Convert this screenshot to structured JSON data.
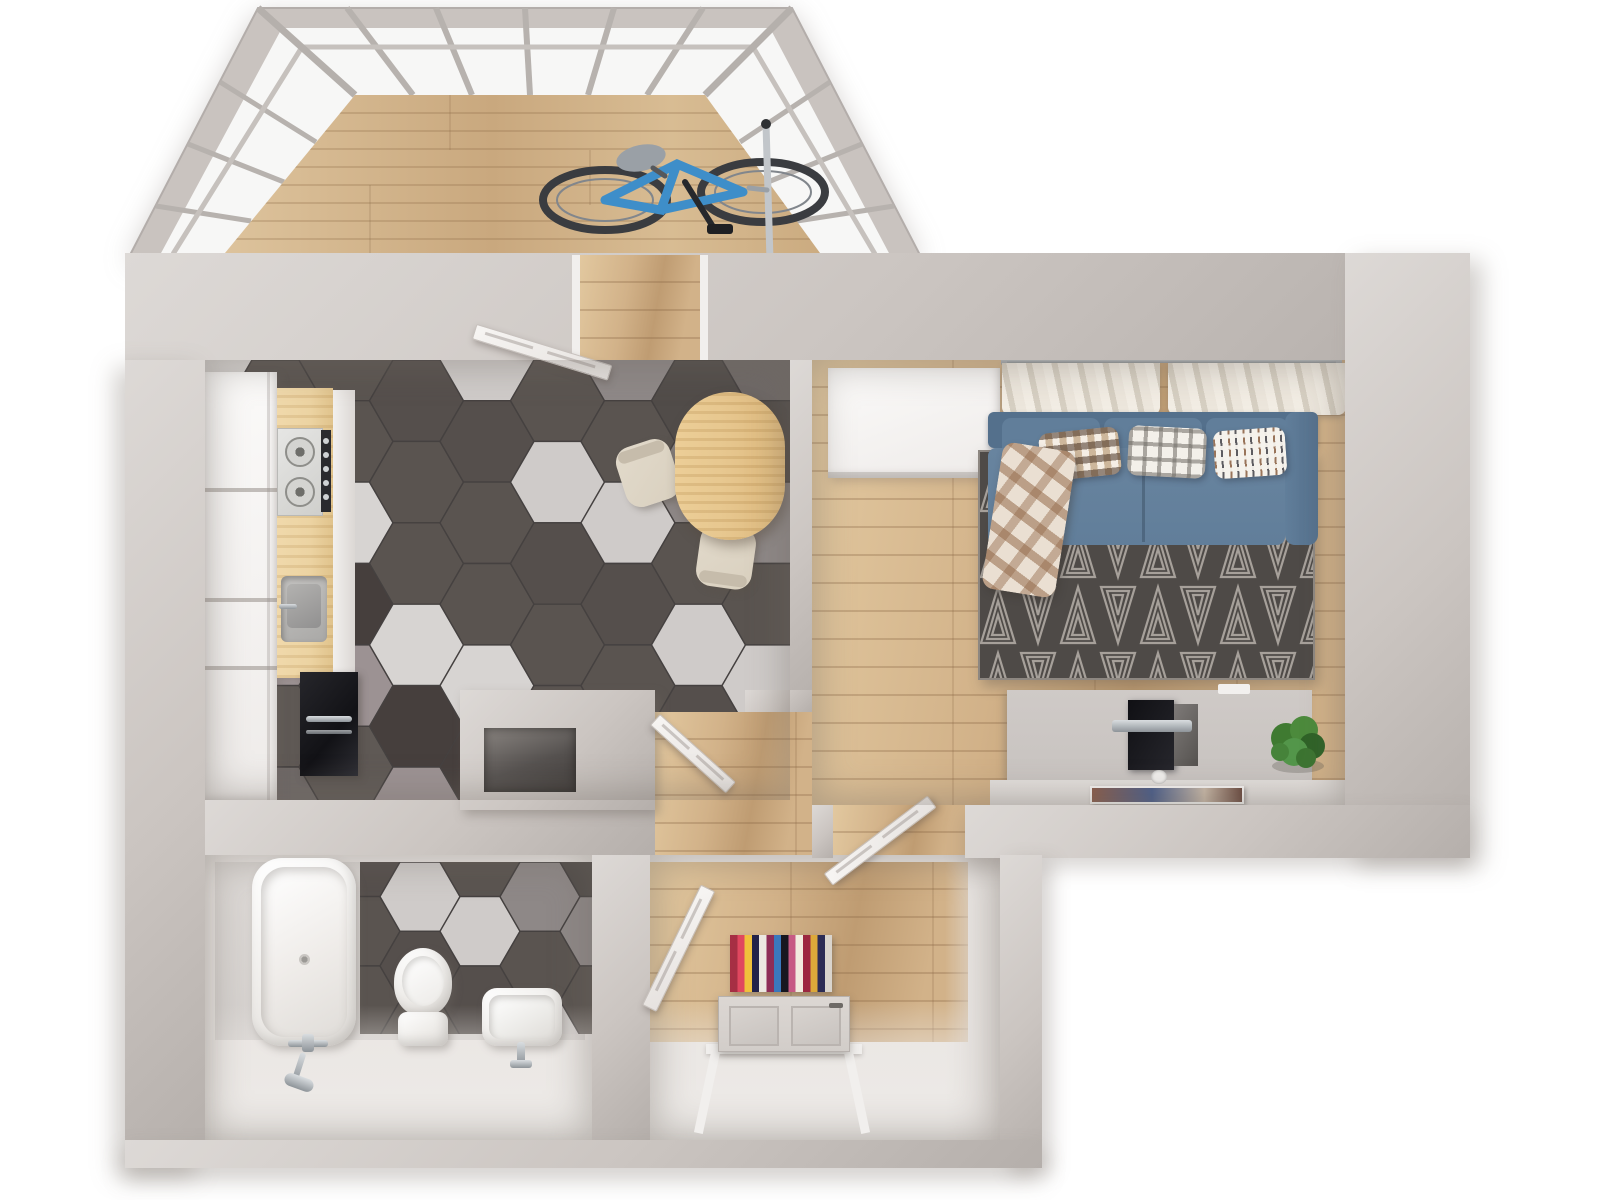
{
  "scene": {
    "type": "3d-floorplan-top-view",
    "subject": "one-bedroom apartment render",
    "background": "#ffffff"
  },
  "colors": {
    "wall": "#cbc5c1",
    "wall_light": "#ddd9d6",
    "wall_dark": "#b5afab",
    "wall_face": "#eae6e3",
    "wood": "#d2b289",
    "wood_dark": "#bf9c72",
    "wood_light": "#e2c89f",
    "glass": "#f7f7f6",
    "mullion": "#b7b2ae",
    "tile_grout": "#454140",
    "sofa": "#54708c",
    "sofa_mid": "#617e9a",
    "sofa_light": "#68849f",
    "rug_bg": "#4e4a47",
    "rug_line": "#b5afa8",
    "curtain_a": "#f2ede4",
    "curtain_b": "#d6cfc2",
    "wardrobe": "#f4f2f0",
    "table_wood": "#e7c78f",
    "chair": "#d9d0bf",
    "counter": "#ecd3a2",
    "steel": "#d9d9d7",
    "appliance": "#1c1b1f",
    "chrome_c": "#a8adb2",
    "desk": "#c8c3c0",
    "desk_top": "#dcd8d5",
    "tv": "#17171b",
    "plant": "#4c8a3c",
    "plant_dark": "#2f6227",
    "art1": "#17493a",
    "art2": "#2e7a52",
    "art3": "#3b7a66",
    "door": "#f3f1ee",
    "front_door": "#d2cdc9",
    "bike_frame": "#3e8ec9",
    "bike_dark": "#3a3c40"
  },
  "hex_palette": [
    "#5a5450",
    "#514c49",
    "#d7d4d2",
    "#5a5450",
    "#9c9293",
    "#554f4c",
    "#6e6866",
    "#5a5450",
    "#8e8887",
    "#463f3d",
    "#cfcbc9",
    "#5f5955"
  ],
  "hall_rug_stripes": [
    "#a62f44",
    "#e0475f",
    "#f0c03c",
    "#22224a",
    "#ece8e1",
    "#8e2d56",
    "#3a78bd",
    "#17171f",
    "#c75a84",
    "#f2ecdf",
    "#9c2740",
    "#dca93a",
    "#2c2c55",
    "#d9d4cd"
  ],
  "rooms": [
    {
      "id": "balcony",
      "label": "balcony",
      "floor": "wood-plank",
      "features": [
        "panoramic-window-band",
        "bicycle"
      ]
    },
    {
      "id": "kitchen",
      "label": "kitchen-dining",
      "floor": "hexagon-tile",
      "features": [
        "tall-white-cabinets",
        "wood-counter",
        "gas-hob",
        "sink",
        "oven",
        "oval-dining-table",
        "two-chairs",
        "open-balcony-door"
      ]
    },
    {
      "id": "living-room",
      "label": "living-room",
      "floor": "wood-plank",
      "features": [
        "white-wardrobe",
        "curtain-rod",
        "two-curtains",
        "blue-sofa",
        "three-pillows",
        "plaid-blanket",
        "triangle-pattern-rug",
        "tv-desk",
        "tv",
        "plant",
        "magazine",
        "three-green-artworks",
        "open-door"
      ]
    },
    {
      "id": "bathroom",
      "label": "bathroom",
      "floor": "hexagon-tile-partial",
      "features": [
        "bathtub",
        "shower-mixer",
        "toilet",
        "wash-basin"
      ]
    },
    {
      "id": "hallway",
      "label": "hallway",
      "floor": "wood-plank",
      "features": [
        "striped-rug",
        "front-door-open",
        "open-interior-door"
      ]
    },
    {
      "id": "shaft",
      "label": "ventilation-shaft",
      "features": [
        "duct-opening"
      ]
    }
  ]
}
